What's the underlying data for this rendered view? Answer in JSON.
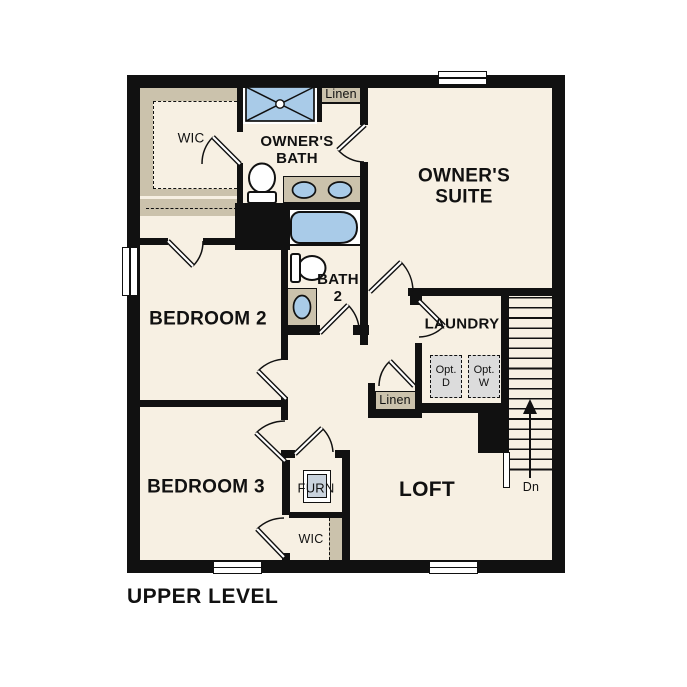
{
  "title": "UPPER LEVEL",
  "labels": {
    "wic_owner": "WIC",
    "owners_bath": "OWNER'S\nBATH",
    "linen_upper": "Linen",
    "owners_suite": "OWNER'S\nSUITE",
    "bedroom_2": "BEDROOM 2",
    "bath_2": "BATH\n2",
    "laundry": "LAUNDRY",
    "linen_lower": "Linen",
    "opt_dryer": "Opt.\nD",
    "opt_washer": "Opt.\nW",
    "bedroom_3": "BEDROOM 3",
    "furnace": "FURN",
    "loft": "LOFT",
    "wic_bedroom3": "WIC",
    "stairs_direction": "Dn"
  },
  "colors": {
    "wall": "#111111",
    "floor": "#F7F0E3",
    "closet_shelving": "#CBC2AC",
    "plumbing_fixture": "#A9CBE8",
    "optional_appliance": "#DCDCDC",
    "furnace_unit": "#C9D3DE"
  }
}
